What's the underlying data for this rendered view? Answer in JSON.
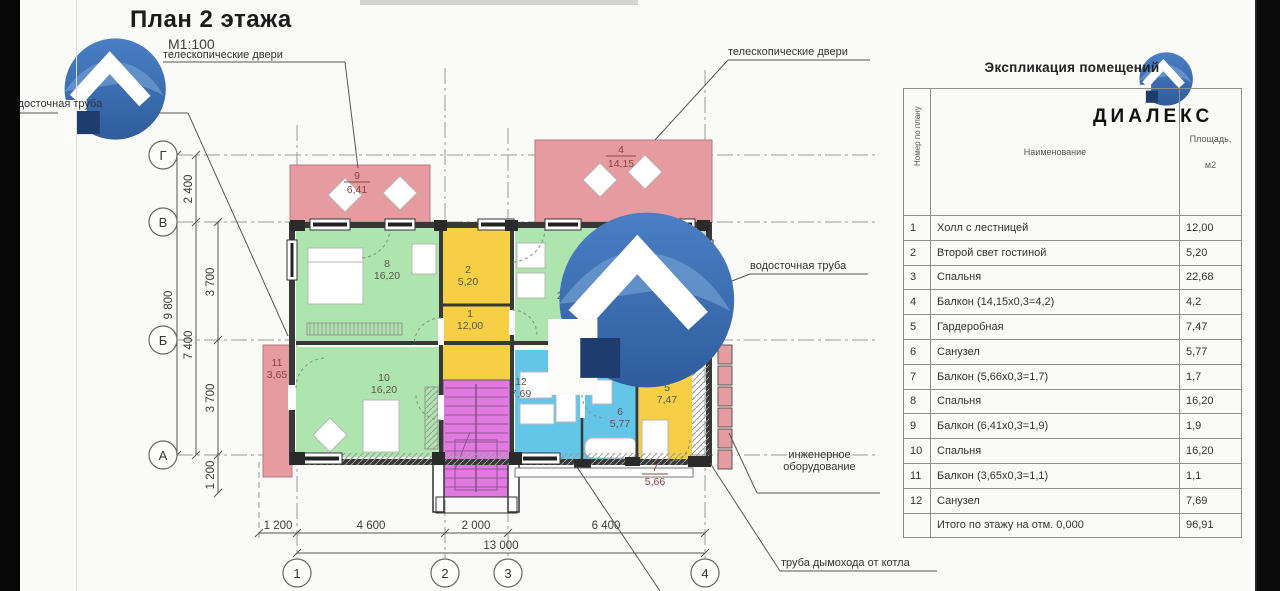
{
  "page": {
    "title": "План 2 этажа",
    "scale": "М1:100"
  },
  "logo": {
    "name": "ДИАЛЕКС"
  },
  "annotations": {
    "telescopic_doors_left": "телескопические двери",
    "telescopic_doors_right": "телескопические двери",
    "drainpipe_left": "водосточная труба",
    "drainpipe_right": "водосточная труба",
    "engineering_line1": "инженерное",
    "engineering_line2": "оборудование",
    "chimney": "труба дымохода от котла"
  },
  "axes": {
    "horizontal": [
      "Г",
      "В",
      "Б",
      "А"
    ],
    "vertical": [
      "1",
      "2",
      "3",
      "4"
    ]
  },
  "dimensions": {
    "left_total": "9 800",
    "left_top": "2 400",
    "left_span": "7 400",
    "left_mid1": "3 700",
    "left_mid2": "3 700",
    "left_low": "1 200",
    "bottom_1": "1 200",
    "bottom_2": "4 600",
    "bottom_3": "2 000",
    "bottom_4": "6 400",
    "bottom_total": "13 000"
  },
  "plan": {
    "labels": [
      {
        "number": "1",
        "area": "12,00"
      },
      {
        "number": "2",
        "area": "5,20"
      },
      {
        "number": "3",
        "area": "22,68"
      },
      {
        "number": "4",
        "area": "14,15"
      },
      {
        "number": "5",
        "area": "7,47"
      },
      {
        "number": "6",
        "area": "5,77"
      },
      {
        "number": "7",
        "area": "5,66"
      },
      {
        "number": "8",
        "area": "16,20"
      },
      {
        "number": "9",
        "area": "6,41"
      },
      {
        "number": "10",
        "area": "16,20"
      },
      {
        "number": "11",
        "area": "3,65"
      },
      {
        "number": "12",
        "area": "7,69"
      }
    ]
  },
  "table": {
    "title": "Экспликация помещений",
    "col_num": "Номер по плану",
    "col_name": "Наименование",
    "col_area_1": "Площадь,",
    "col_area_2": "м2",
    "rows": [
      {
        "num": "1",
        "name": "Холл с лестницей",
        "area": "12,00"
      },
      {
        "num": "2",
        "name": "Второй свет гостиной",
        "area": "5,20"
      },
      {
        "num": "3",
        "name": "Спальня",
        "area": "22,68"
      },
      {
        "num": "4",
        "name": "Балкон (14,15х0,3=4,2)",
        "area": "4,2"
      },
      {
        "num": "5",
        "name": "Гардеробная",
        "area": "7,47"
      },
      {
        "num": "6",
        "name": "Санузел",
        "area": "5,77"
      },
      {
        "num": "7",
        "name": "Балкон (5,66х0,3=1,7)",
        "area": "1,7"
      },
      {
        "num": "8",
        "name": "Спальня",
        "area": "16,20"
      },
      {
        "num": "9",
        "name": "Балкон (6,41х0,3=1,9)",
        "area": "1,9"
      },
      {
        "num": "10",
        "name": "Спальня",
        "area": "16,20"
      },
      {
        "num": "11",
        "name": "Балкон (3,65х0,3=1,1)",
        "area": "1,1"
      },
      {
        "num": "12",
        "name": "Санузел",
        "area": "7,69"
      }
    ],
    "total_label": "Итого по этажу на отм. 0,000",
    "total_area": "96,91"
  },
  "colors": {
    "room_green": "#aee5ae",
    "room_yellow": "#f6cf45",
    "room_blue": "#63c6e8",
    "stairs_magenta": "#e07ae0",
    "balcony_pink": "#e59b9f",
    "logo_blue": "#3a6db4",
    "logo_navy": "#1e3c6e"
  }
}
